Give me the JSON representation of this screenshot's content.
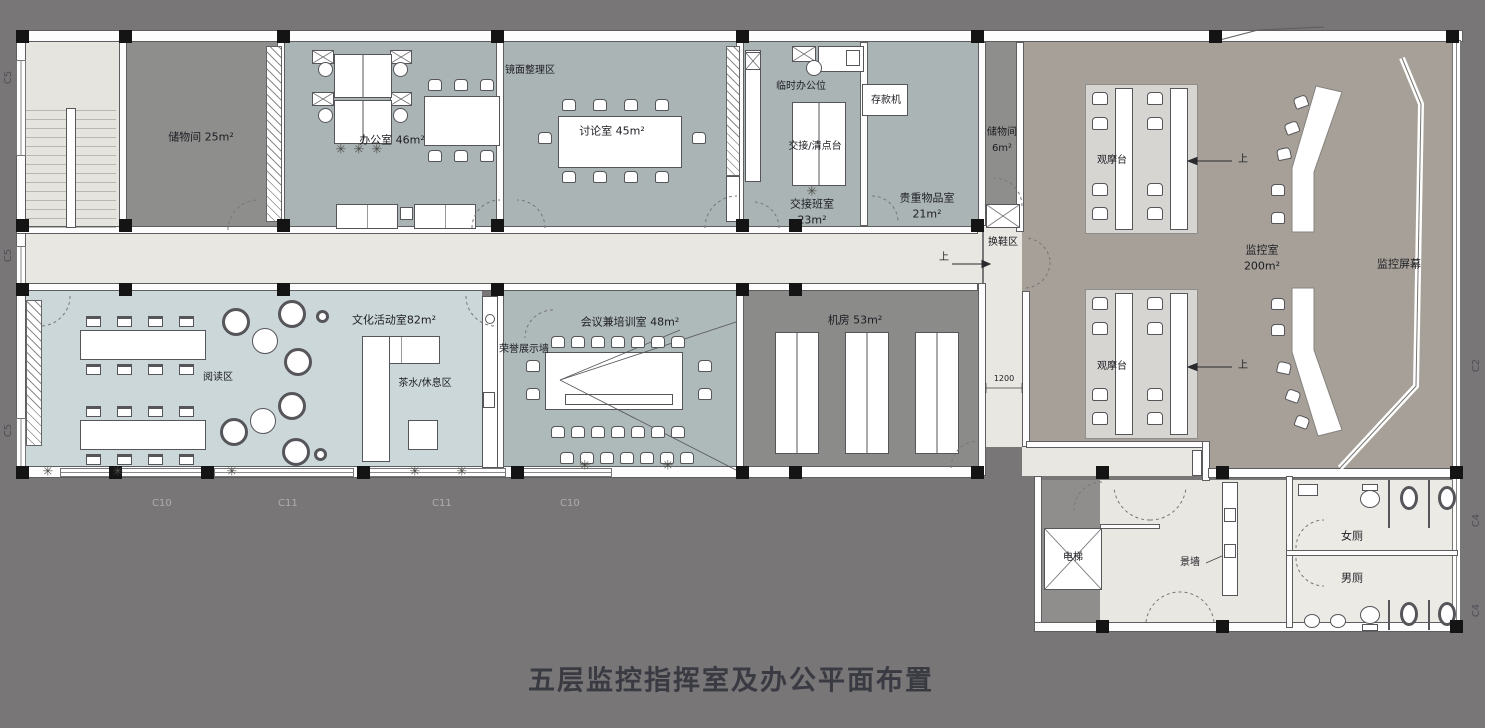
{
  "title": "五层监控指挥室及办公平面布置",
  "labels": {
    "storage_25": "储物间 25m²",
    "office_46": "办公室 46m²",
    "mirror_area": "镜面整理区",
    "discussion_45": "讨论室 45m²",
    "temp_office": "临时办公位",
    "deposit_machine": "存款机",
    "handover_counter": "交接/清点台",
    "handover_room": "交接班室",
    "handover_area": "23m²",
    "valuables_room": "贵重物品室",
    "valuables_area": "21m²",
    "storage_6": "储物间",
    "storage_6_area": "6m²",
    "shoe_change": "换鞋区",
    "up": "上",
    "observation_desk": "观摩台",
    "monitor_room": "监控室",
    "monitor_room_area": "200m²",
    "monitor_screen": "监控屏幕",
    "culture_room": "文化活动室82m²",
    "reading_area": "阅读区",
    "tea_rest_area": "茶水/休息区",
    "honor_wall": "荣誉展示墙",
    "meeting_room": "会议兼培训室 48m²",
    "machine_room": "机房 53m²",
    "dim_1200": "1200",
    "elevator": "电梯",
    "feature_wall": "景墙",
    "women_toilet": "女厕",
    "men_toilet": "男厕"
  },
  "markers": {
    "left": [
      "C5",
      "C5",
      "C5"
    ],
    "bottom": [
      "C10",
      "C11",
      "C11",
      "C10"
    ],
    "right": [
      "C2",
      "C4",
      "C4"
    ]
  },
  "colors": {
    "background": "#787677",
    "corridor": "#e9e7e1",
    "office_room": "#aab4b5",
    "storage_room": "#8e8e8c",
    "culture_room": "#cbd7d8",
    "machine_room": "#8b8b8a",
    "monitor_room": "#a6a098",
    "wall": "#fdfdfd",
    "column": "#141414"
  }
}
